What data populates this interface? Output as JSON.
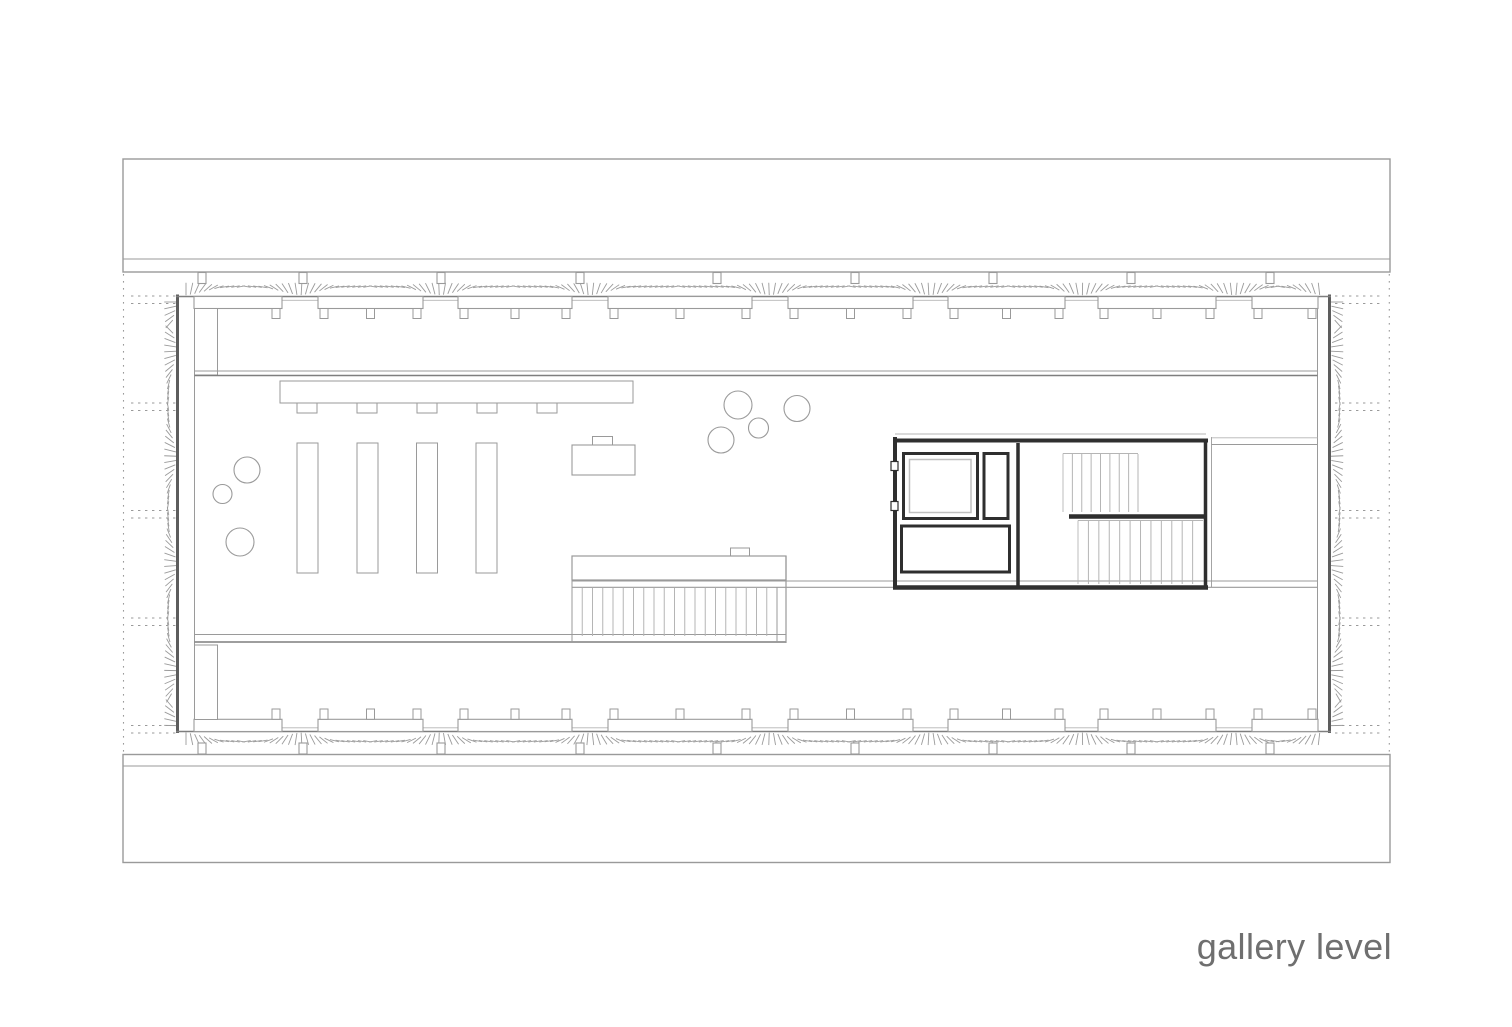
{
  "caption": {
    "label": "gallery level"
  },
  "drawing": {
    "type": "architectural-floor-plan",
    "level_label": "gallery level",
    "features": [
      "upper-roof-band",
      "lower-roof-band",
      "structural-grid-dotted-lines",
      "perimeter-insulation-hatch",
      "window-bench-rows",
      "roof-posts",
      "gallery-void-edges",
      "display-counter",
      "display-plinths",
      "reception-desk",
      "plants",
      "main-stair",
      "service-core",
      "elevator-shaft",
      "core-stair-flights",
      "side-room"
    ]
  },
  "palette": {
    "background": "#ffffff",
    "line_faint": "#b5b5b5",
    "line_light": "#9a9a9a",
    "line_medium": "#7e7e7e",
    "line_strong": "#5d5d5d",
    "core_wall": "#2f2f2f",
    "tread": "#b5b5b5",
    "hatch": "#9b9b9b",
    "elevator_car": "#c0c0c0",
    "caption_text": "#6f6f6f"
  }
}
